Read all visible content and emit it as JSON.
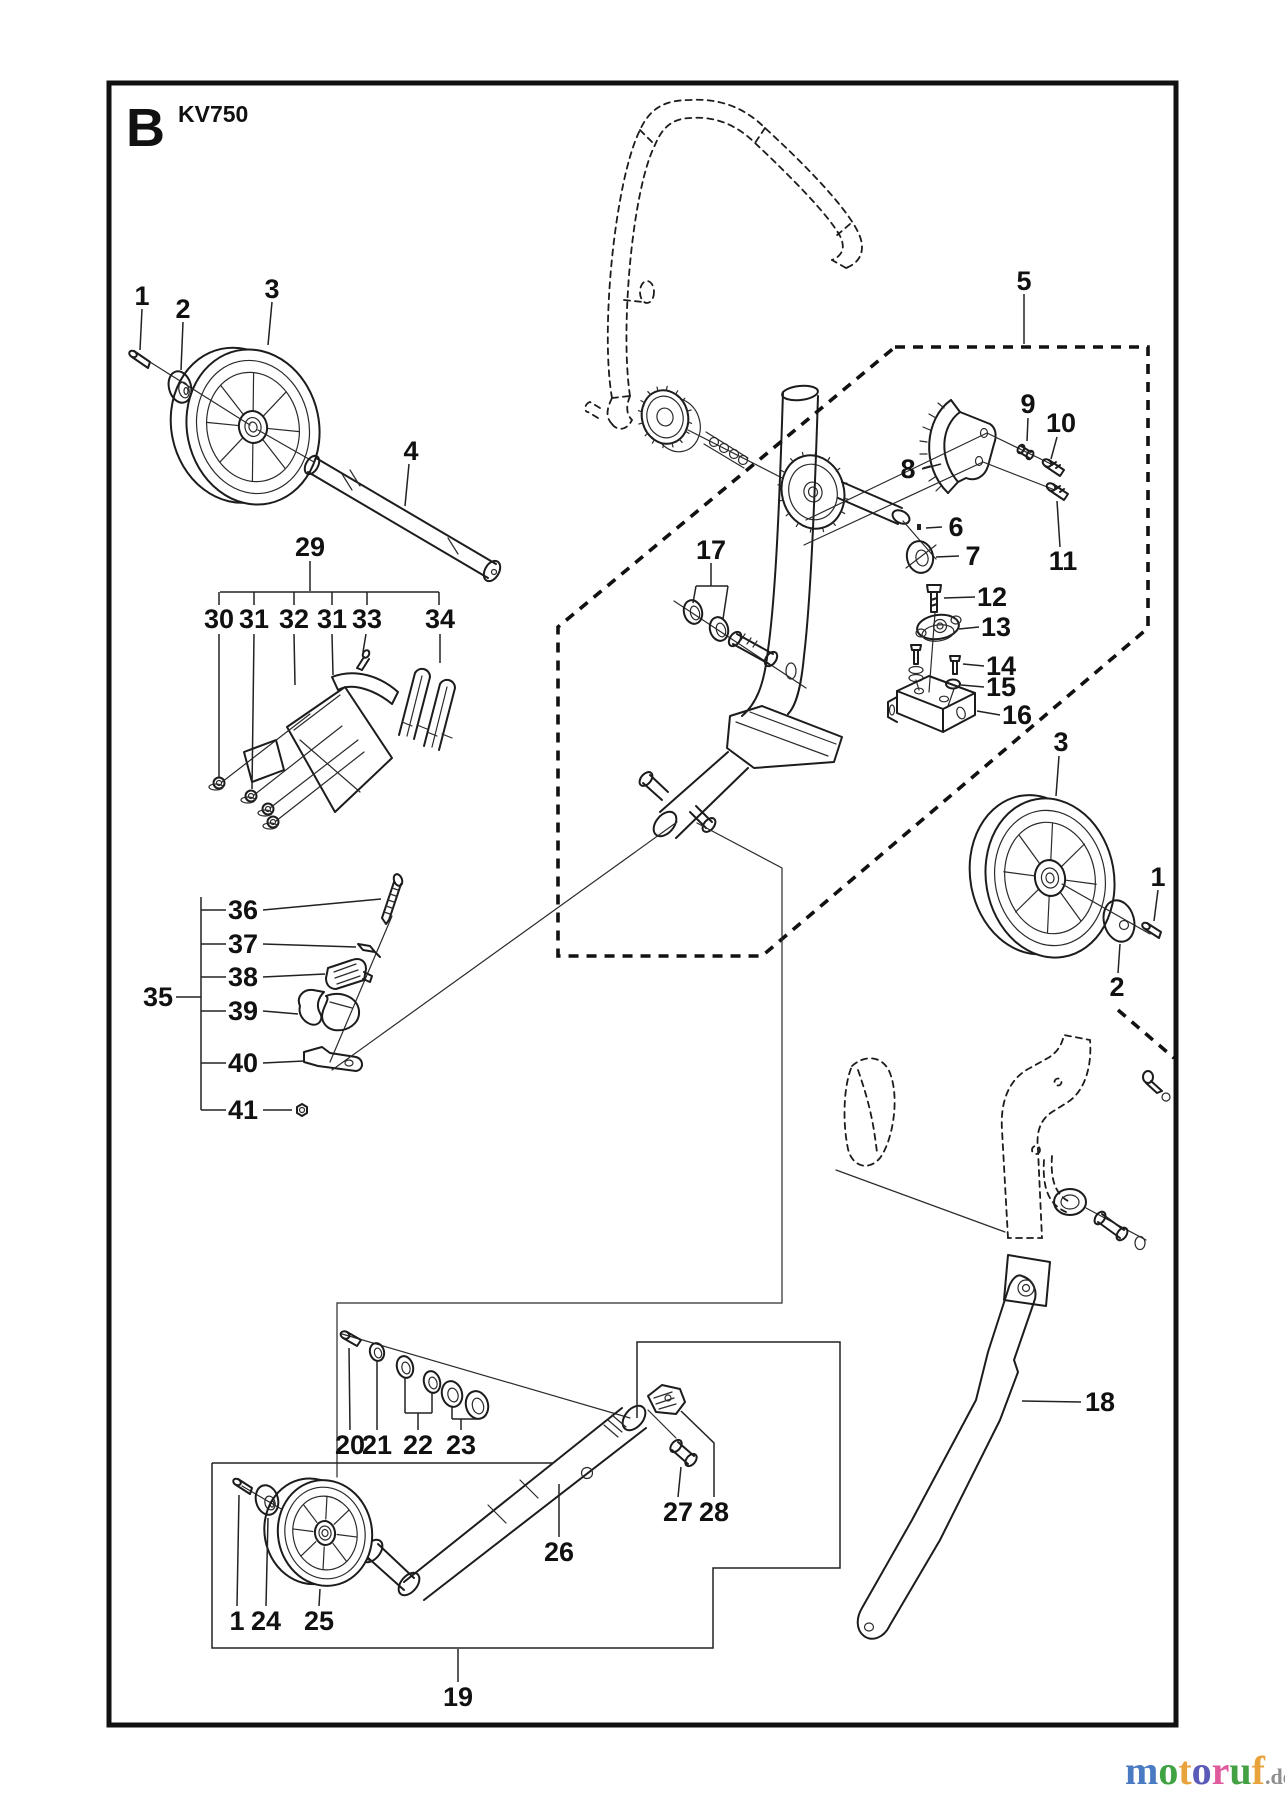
{
  "header": {
    "section": "B",
    "model": "KV750"
  },
  "watermark": {
    "letters": [
      {
        "ch": "m",
        "color": "#4a7ac2"
      },
      {
        "ch": "o",
        "color": "#3fa243"
      },
      {
        "ch": "t",
        "color": "#e8a33d"
      },
      {
        "ch": "o",
        "color": "#5a5ab8"
      },
      {
        "ch": "r",
        "color": "#df5b9e"
      },
      {
        "ch": "u",
        "color": "#43a143"
      },
      {
        "ch": "f",
        "color": "#e8a33d"
      }
    ],
    "tld": ".de",
    "tld_color": "#8e8e8e"
  },
  "callouts": [
    {
      "label": "1",
      "x": 142,
      "y": 296,
      "leader": [
        [
          142,
          309
        ],
        [
          140,
          350
        ]
      ]
    },
    {
      "label": "2",
      "x": 183,
      "y": 309,
      "leader": [
        [
          183,
          322
        ],
        [
          181,
          370
        ]
      ]
    },
    {
      "label": "3",
      "x": 272,
      "y": 289,
      "leader": [
        [
          272,
          302
        ],
        [
          268,
          345
        ]
      ]
    },
    {
      "label": "4",
      "x": 411,
      "y": 451,
      "leader": [
        [
          409,
          464
        ],
        [
          405,
          506
        ]
      ]
    },
    {
      "label": "5",
      "x": 1024,
      "y": 281,
      "leader": [
        [
          1024,
          294
        ],
        [
          1024,
          344
        ]
      ]
    },
    {
      "label": "6",
      "x": 956,
      "y": 527,
      "leader": [
        [
          942,
          527
        ],
        [
          926,
          528
        ]
      ]
    },
    {
      "label": "7",
      "x": 973,
      "y": 556,
      "leader": [
        [
          959,
          556
        ],
        [
          936,
          557
        ]
      ]
    },
    {
      "label": "8",
      "x": 908,
      "y": 469,
      "leader": [
        [
          922,
          469
        ],
        [
          941,
          464
        ]
      ]
    },
    {
      "label": "9",
      "x": 1028,
      "y": 404,
      "leader": [
        [
          1028,
          418
        ],
        [
          1027,
          441
        ]
      ]
    },
    {
      "label": "10",
      "x": 1061,
      "y": 423,
      "leader": [
        [
          1057,
          437
        ],
        [
          1051,
          459
        ]
      ]
    },
    {
      "label": "11",
      "x": 1063,
      "y": 561,
      "leader": [
        [
          1060,
          547
        ],
        [
          1057,
          501
        ]
      ]
    },
    {
      "label": "12",
      "x": 992,
      "y": 597,
      "leader": [
        [
          975,
          597
        ],
        [
          944,
          598
        ]
      ]
    },
    {
      "label": "13",
      "x": 996,
      "y": 627,
      "leader": [
        [
          979,
          627
        ],
        [
          959,
          629
        ]
      ]
    },
    {
      "label": "14",
      "x": 1001,
      "y": 666,
      "leader": [
        [
          984,
          666
        ],
        [
          963,
          664
        ]
      ]
    },
    {
      "label": "15",
      "x": 1001,
      "y": 687,
      "leader": [
        [
          984,
          687
        ],
        [
          961,
          685
        ]
      ]
    },
    {
      "label": "16",
      "x": 1017,
      "y": 715,
      "leader": [
        [
          1000,
          715
        ],
        [
          977,
          711
        ]
      ]
    },
    {
      "label": "17",
      "x": 711,
      "y": 550
    },
    {
      "label": "18",
      "x": 1100,
      "y": 1402,
      "leader": [
        [
          1081,
          1402
        ],
        [
          1022,
          1401
        ]
      ]
    },
    {
      "label": "19",
      "x": 458,
      "y": 1697,
      "leader": [
        [
          458,
          1682
        ],
        [
          458,
          1649
        ]
      ]
    },
    {
      "label": "20",
      "x": 350,
      "y": 1445,
      "leader": [
        [
          350,
          1430
        ],
        [
          349,
          1348
        ]
      ]
    },
    {
      "label": "21",
      "x": 377,
      "y": 1445,
      "leader": [
        [
          377,
          1430
        ],
        [
          377,
          1361
        ]
      ]
    },
    {
      "label": "22",
      "x": 418,
      "y": 1445
    },
    {
      "label": "23",
      "x": 461,
      "y": 1445
    },
    {
      "label": "24",
      "x": 266,
      "y": 1621,
      "leader": [
        [
          266,
          1606
        ],
        [
          268,
          1518
        ]
      ]
    },
    {
      "label": "25",
      "x": 319,
      "y": 1621,
      "leader": [
        [
          319,
          1606
        ],
        [
          320,
          1589
        ]
      ]
    },
    {
      "label": "26",
      "x": 559,
      "y": 1552,
      "leader": [
        [
          559,
          1537
        ],
        [
          559,
          1484
        ]
      ]
    },
    {
      "label": "27",
      "x": 678,
      "y": 1512,
      "leader": [
        [
          678,
          1497
        ],
        [
          681,
          1467
        ]
      ]
    },
    {
      "label": "28",
      "x": 714,
      "y": 1512,
      "leader": [
        [
          714,
          1497
        ],
        [
          714,
          1443
        ],
        [
          681,
          1411
        ]
      ]
    },
    {
      "label": "29",
      "x": 310,
      "y": 547,
      "leader": [
        [
          310,
          561
        ],
        [
          310,
          591
        ]
      ]
    },
    {
      "label": "30",
      "x": 219,
      "y": 619,
      "leader": [
        [
          219,
          634
        ],
        [
          219,
          777
        ]
      ]
    },
    {
      "label": "31",
      "x": 254,
      "y": 619,
      "leader": [
        [
          254,
          634
        ],
        [
          252,
          789
        ]
      ]
    },
    {
      "label": "32",
      "x": 294,
      "y": 619,
      "leader": [
        [
          294,
          634
        ],
        [
          295,
          685
        ]
      ]
    },
    {
      "label": "31",
      "x": 332,
      "y": 619,
      "leader": [
        [
          332,
          634
        ],
        [
          333,
          675
        ]
      ]
    },
    {
      "label": "33",
      "x": 367,
      "y": 619,
      "leader": [
        [
          366,
          634
        ],
        [
          363,
          652
        ]
      ]
    },
    {
      "label": "34",
      "x": 440,
      "y": 619,
      "leader": [
        [
          440,
          634
        ],
        [
          440,
          663
        ]
      ]
    },
    {
      "label": "35",
      "x": 158,
      "y": 997,
      "leader": [
        [
          176,
          997
        ],
        [
          201,
          997
        ]
      ]
    },
    {
      "label": "36",
      "x": 243,
      "y": 910,
      "leader": [
        [
          263,
          910
        ],
        [
          381,
          899
        ]
      ]
    },
    {
      "label": "37",
      "x": 243,
      "y": 944,
      "leader": [
        [
          263,
          944
        ],
        [
          356,
          947
        ]
      ]
    },
    {
      "label": "38",
      "x": 243,
      "y": 977,
      "leader": [
        [
          263,
          977
        ],
        [
          325,
          974
        ]
      ]
    },
    {
      "label": "39",
      "x": 243,
      "y": 1011,
      "leader": [
        [
          263,
          1011
        ],
        [
          298,
          1014
        ]
      ]
    },
    {
      "label": "40",
      "x": 243,
      "y": 1063,
      "leader": [
        [
          263,
          1063
        ],
        [
          304,
          1061
        ]
      ]
    },
    {
      "label": "41",
      "x": 243,
      "y": 1110,
      "leader": [
        [
          263,
          1110
        ],
        [
          292,
          1110
        ]
      ]
    },
    {
      "label": "3",
      "x": 1061,
      "y": 742,
      "leader": [
        [
          1059,
          756
        ],
        [
          1056,
          796
        ]
      ]
    },
    {
      "label": "1",
      "x": 1158,
      "y": 877,
      "leader": [
        [
          1158,
          890
        ],
        [
          1154,
          921
        ]
      ]
    },
    {
      "label": "2",
      "x": 1117,
      "y": 987,
      "leader": [
        [
          1118,
          973
        ],
        [
          1120,
          944
        ]
      ]
    },
    {
      "label": "1",
      "x": 237,
      "y": 1621,
      "leader": [
        [
          237,
          1606
        ],
        [
          239,
          1495
        ]
      ]
    }
  ]
}
